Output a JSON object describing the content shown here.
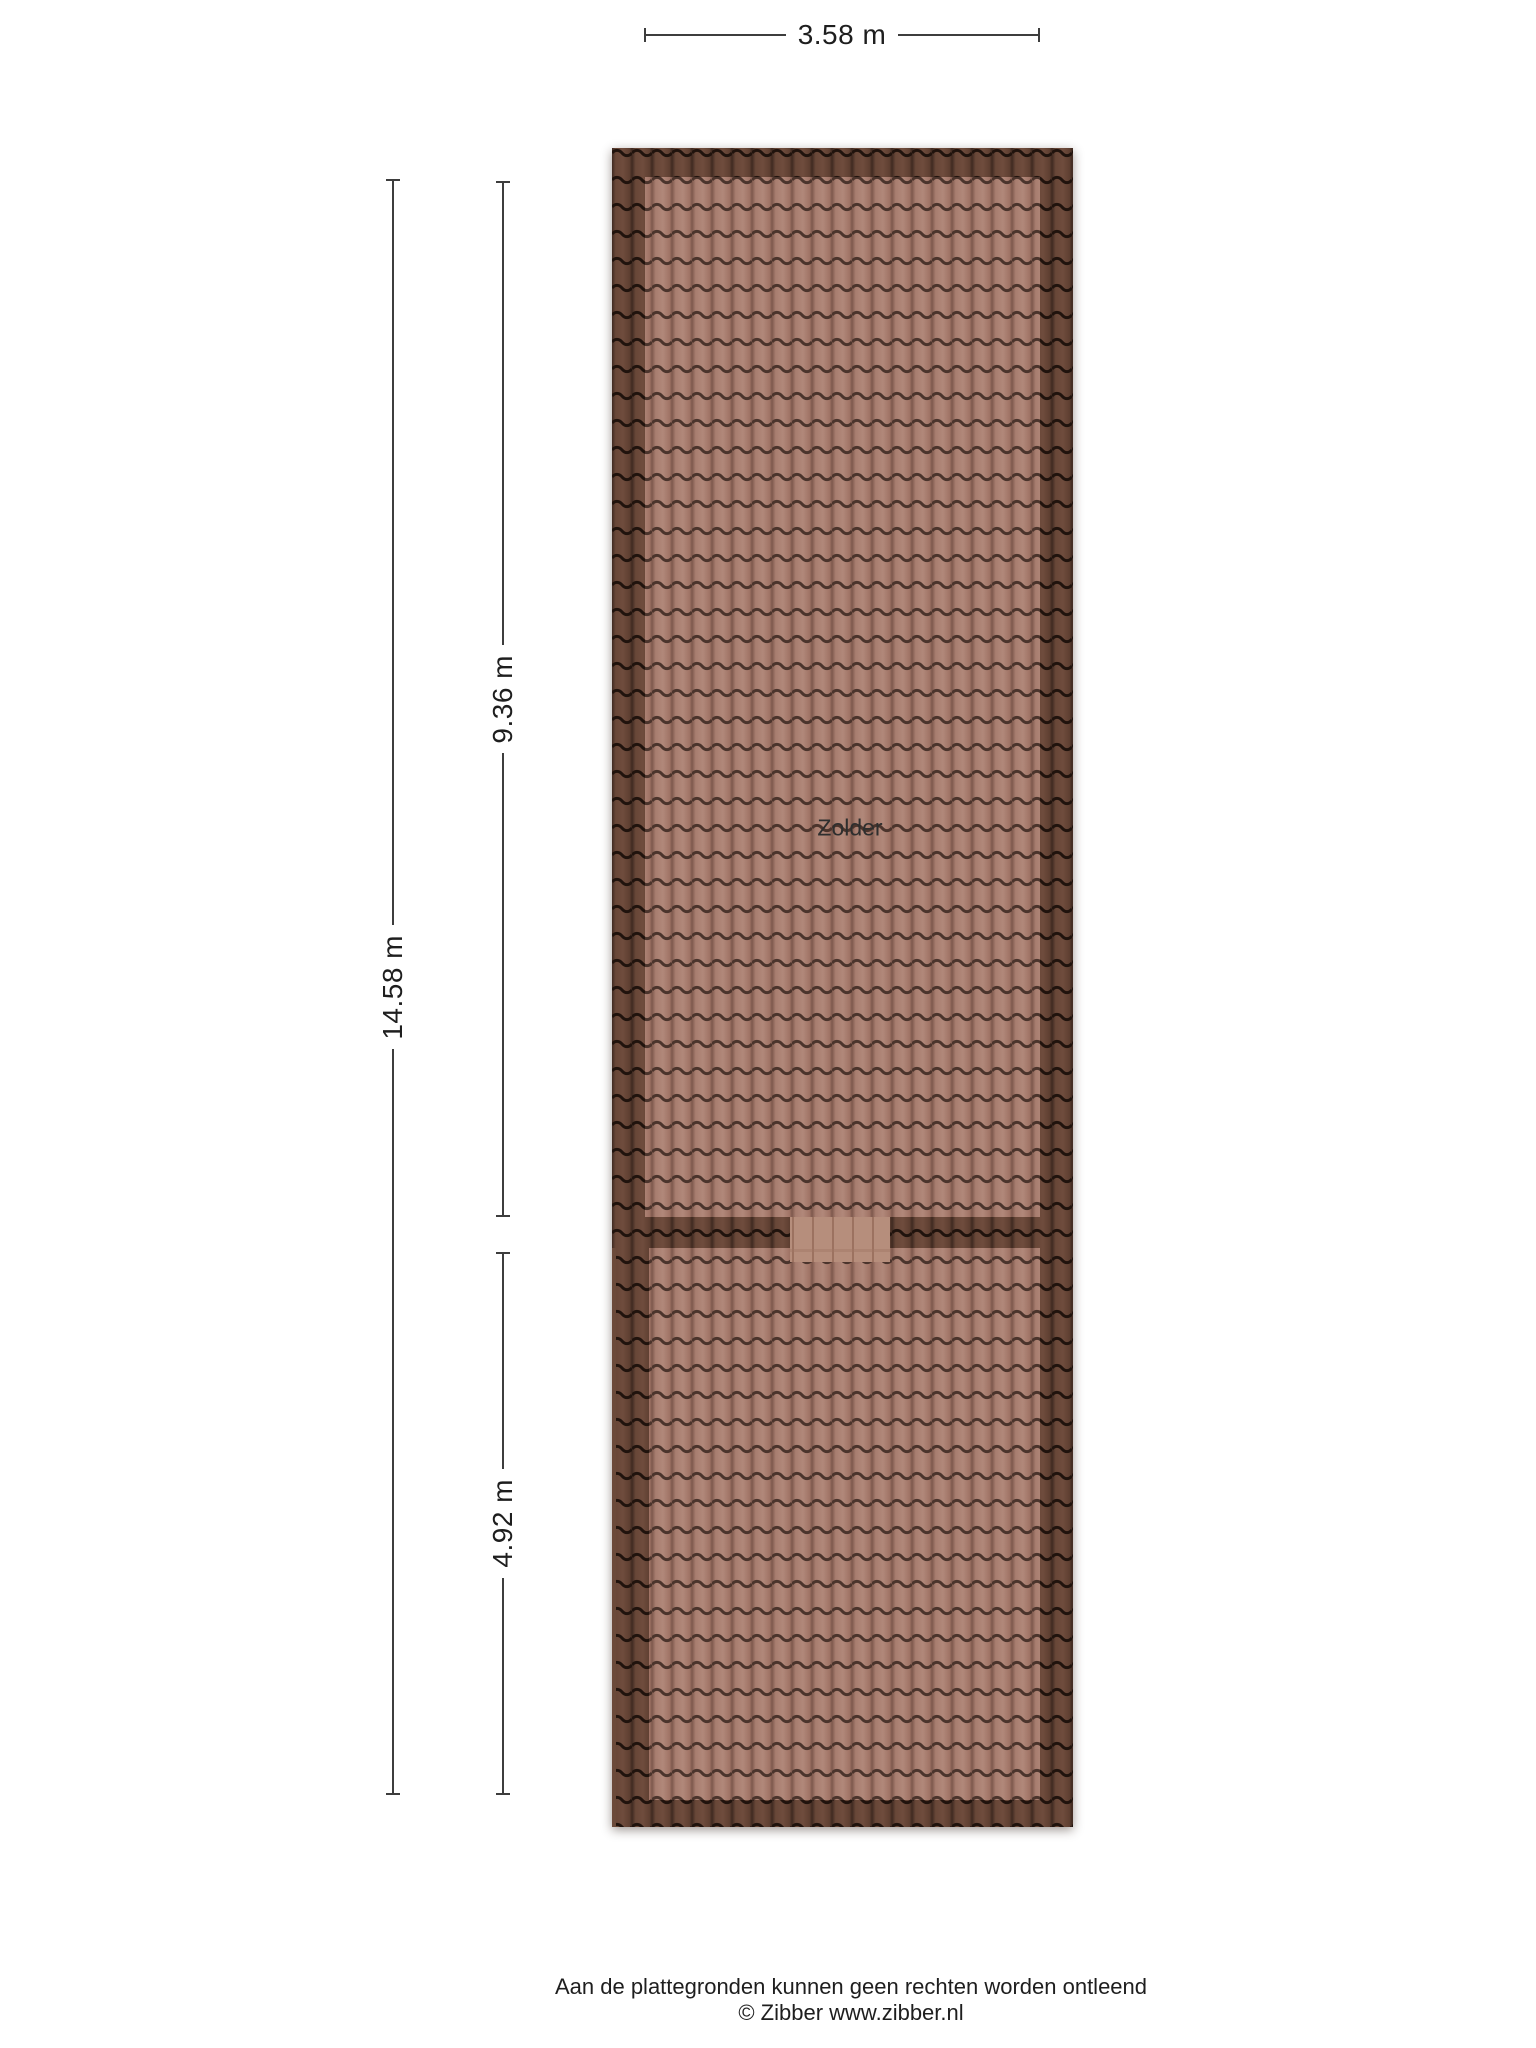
{
  "floorplan": {
    "room_label": "Zolder",
    "dimensions": {
      "width": "3.58 m",
      "total_height": "14.58 m",
      "upper_height": "9.36 m",
      "lower_height": "4.92 m"
    },
    "colors": {
      "tile_light": "#ad8273",
      "tile_light_gap": "#4b342c",
      "tile_dark": "#5e3f31",
      "tile_dark_gap": "#20130d",
      "junction_piece": "#b68e7c",
      "dimension_line": "#3d3d3d",
      "label_text": "#1e1e1e"
    }
  },
  "footer": {
    "disclaimer": "Aan de plattegronden kunnen geen rechten worden ontleend",
    "copyright": "© Zibber www.zibber.nl"
  }
}
